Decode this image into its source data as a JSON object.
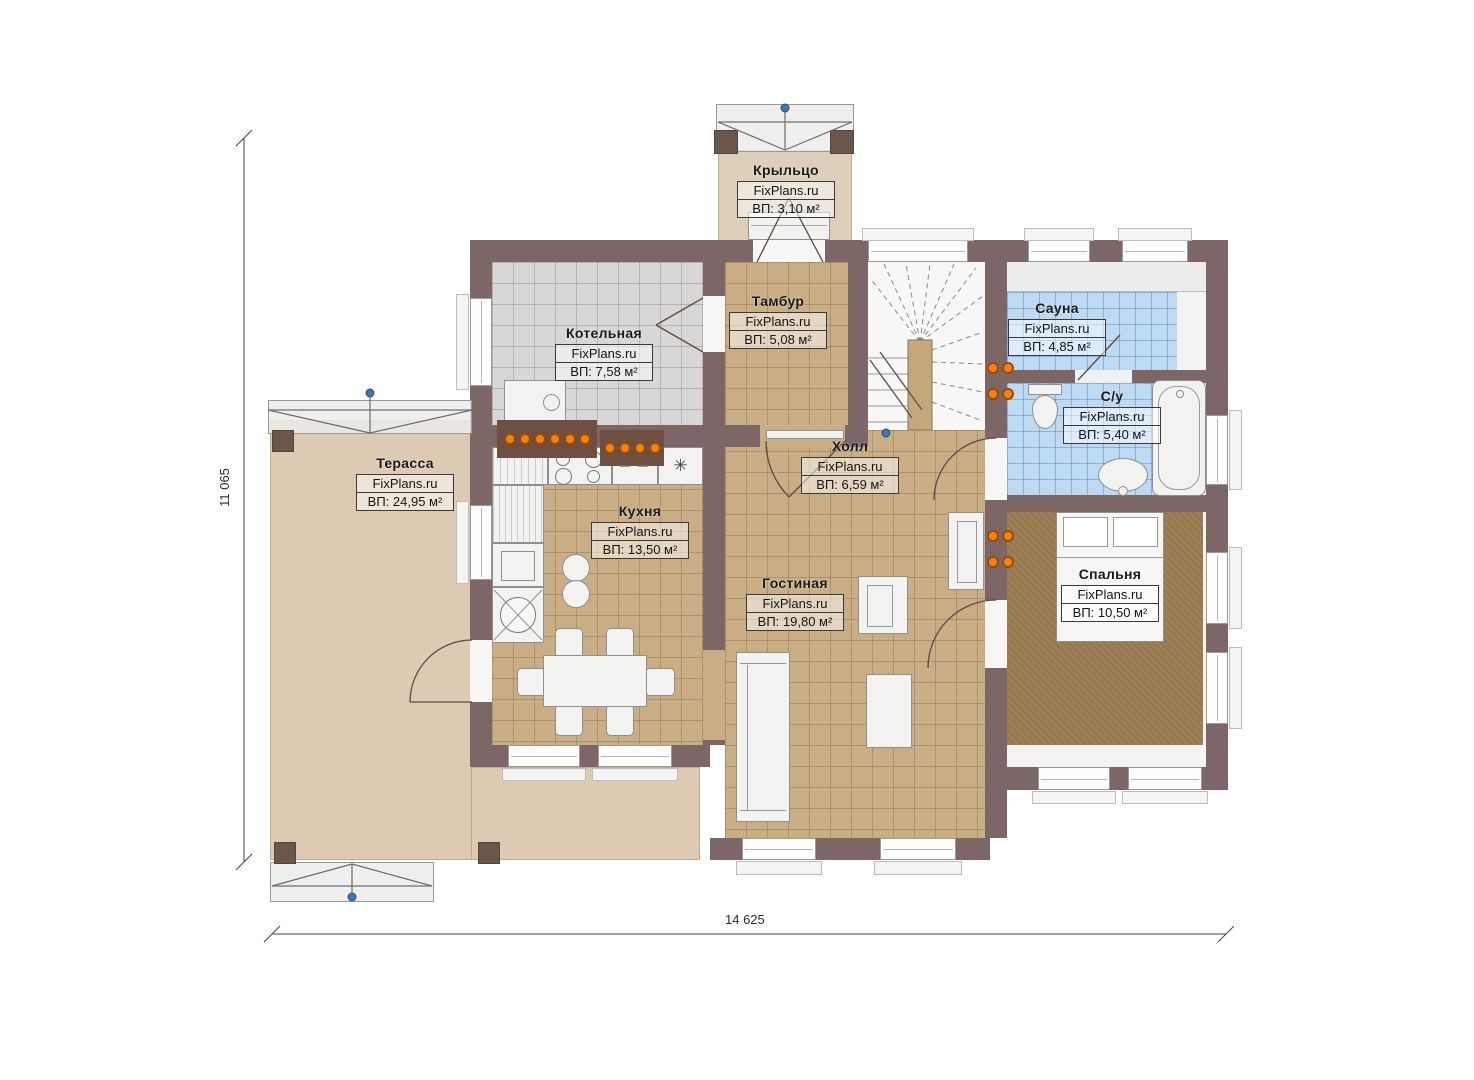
{
  "plan": {
    "brand": "FixPlans.ru",
    "type_label": "floor-plan",
    "dimensions": {
      "width": "14 625",
      "height": "11 065"
    }
  },
  "rooms": [
    {
      "key": "porch",
      "name": "Крыльцо",
      "watermark": "FixPlans.ru",
      "area": "ВП: 3,10 м²"
    },
    {
      "key": "boiler-room",
      "name": "Котельная",
      "watermark": "FixPlans.ru",
      "area": "ВП: 7,58 м²"
    },
    {
      "key": "vestibule",
      "name": "Тамбур",
      "watermark": "FixPlans.ru",
      "area": "ВП: 5,08 м²"
    },
    {
      "key": "sauna",
      "name": "Сауна",
      "watermark": "FixPlans.ru",
      "area": "ВП: 4,85 м²"
    },
    {
      "key": "bathroom",
      "name": "С/у",
      "watermark": "FixPlans.ru",
      "area": "ВП: 5,40 м²"
    },
    {
      "key": "terrace",
      "name": "Терасса",
      "watermark": "FixPlans.ru",
      "area": "ВП: 24,95 м²"
    },
    {
      "key": "kitchen",
      "name": "Кухня",
      "watermark": "FixPlans.ru",
      "area": "ВП: 13,50 м²"
    },
    {
      "key": "hall",
      "name": "Холл",
      "watermark": "FixPlans.ru",
      "area": "ВП: 6,59 м²"
    },
    {
      "key": "living-room",
      "name": "Гостиная",
      "watermark": "FixPlans.ru",
      "area": "ВП: 19,80 м²"
    },
    {
      "key": "bedroom",
      "name": "Спальня",
      "watermark": "FixPlans.ru",
      "area": "ВП: 10,50 м²"
    }
  ],
  "icons": {
    "freezer": "✳"
  },
  "colors": {
    "wall": "#7c6666",
    "post": "#6b564c",
    "floor_tan": "#c9ae85",
    "floor_grey": "#d8d7d5",
    "floor_blue": "#bed9f2",
    "carpet": "#9c8056",
    "terrace": "#dccbb2",
    "porch": "#ddcfba",
    "radiator": "#f3820f",
    "marker": "#3f74b5"
  }
}
